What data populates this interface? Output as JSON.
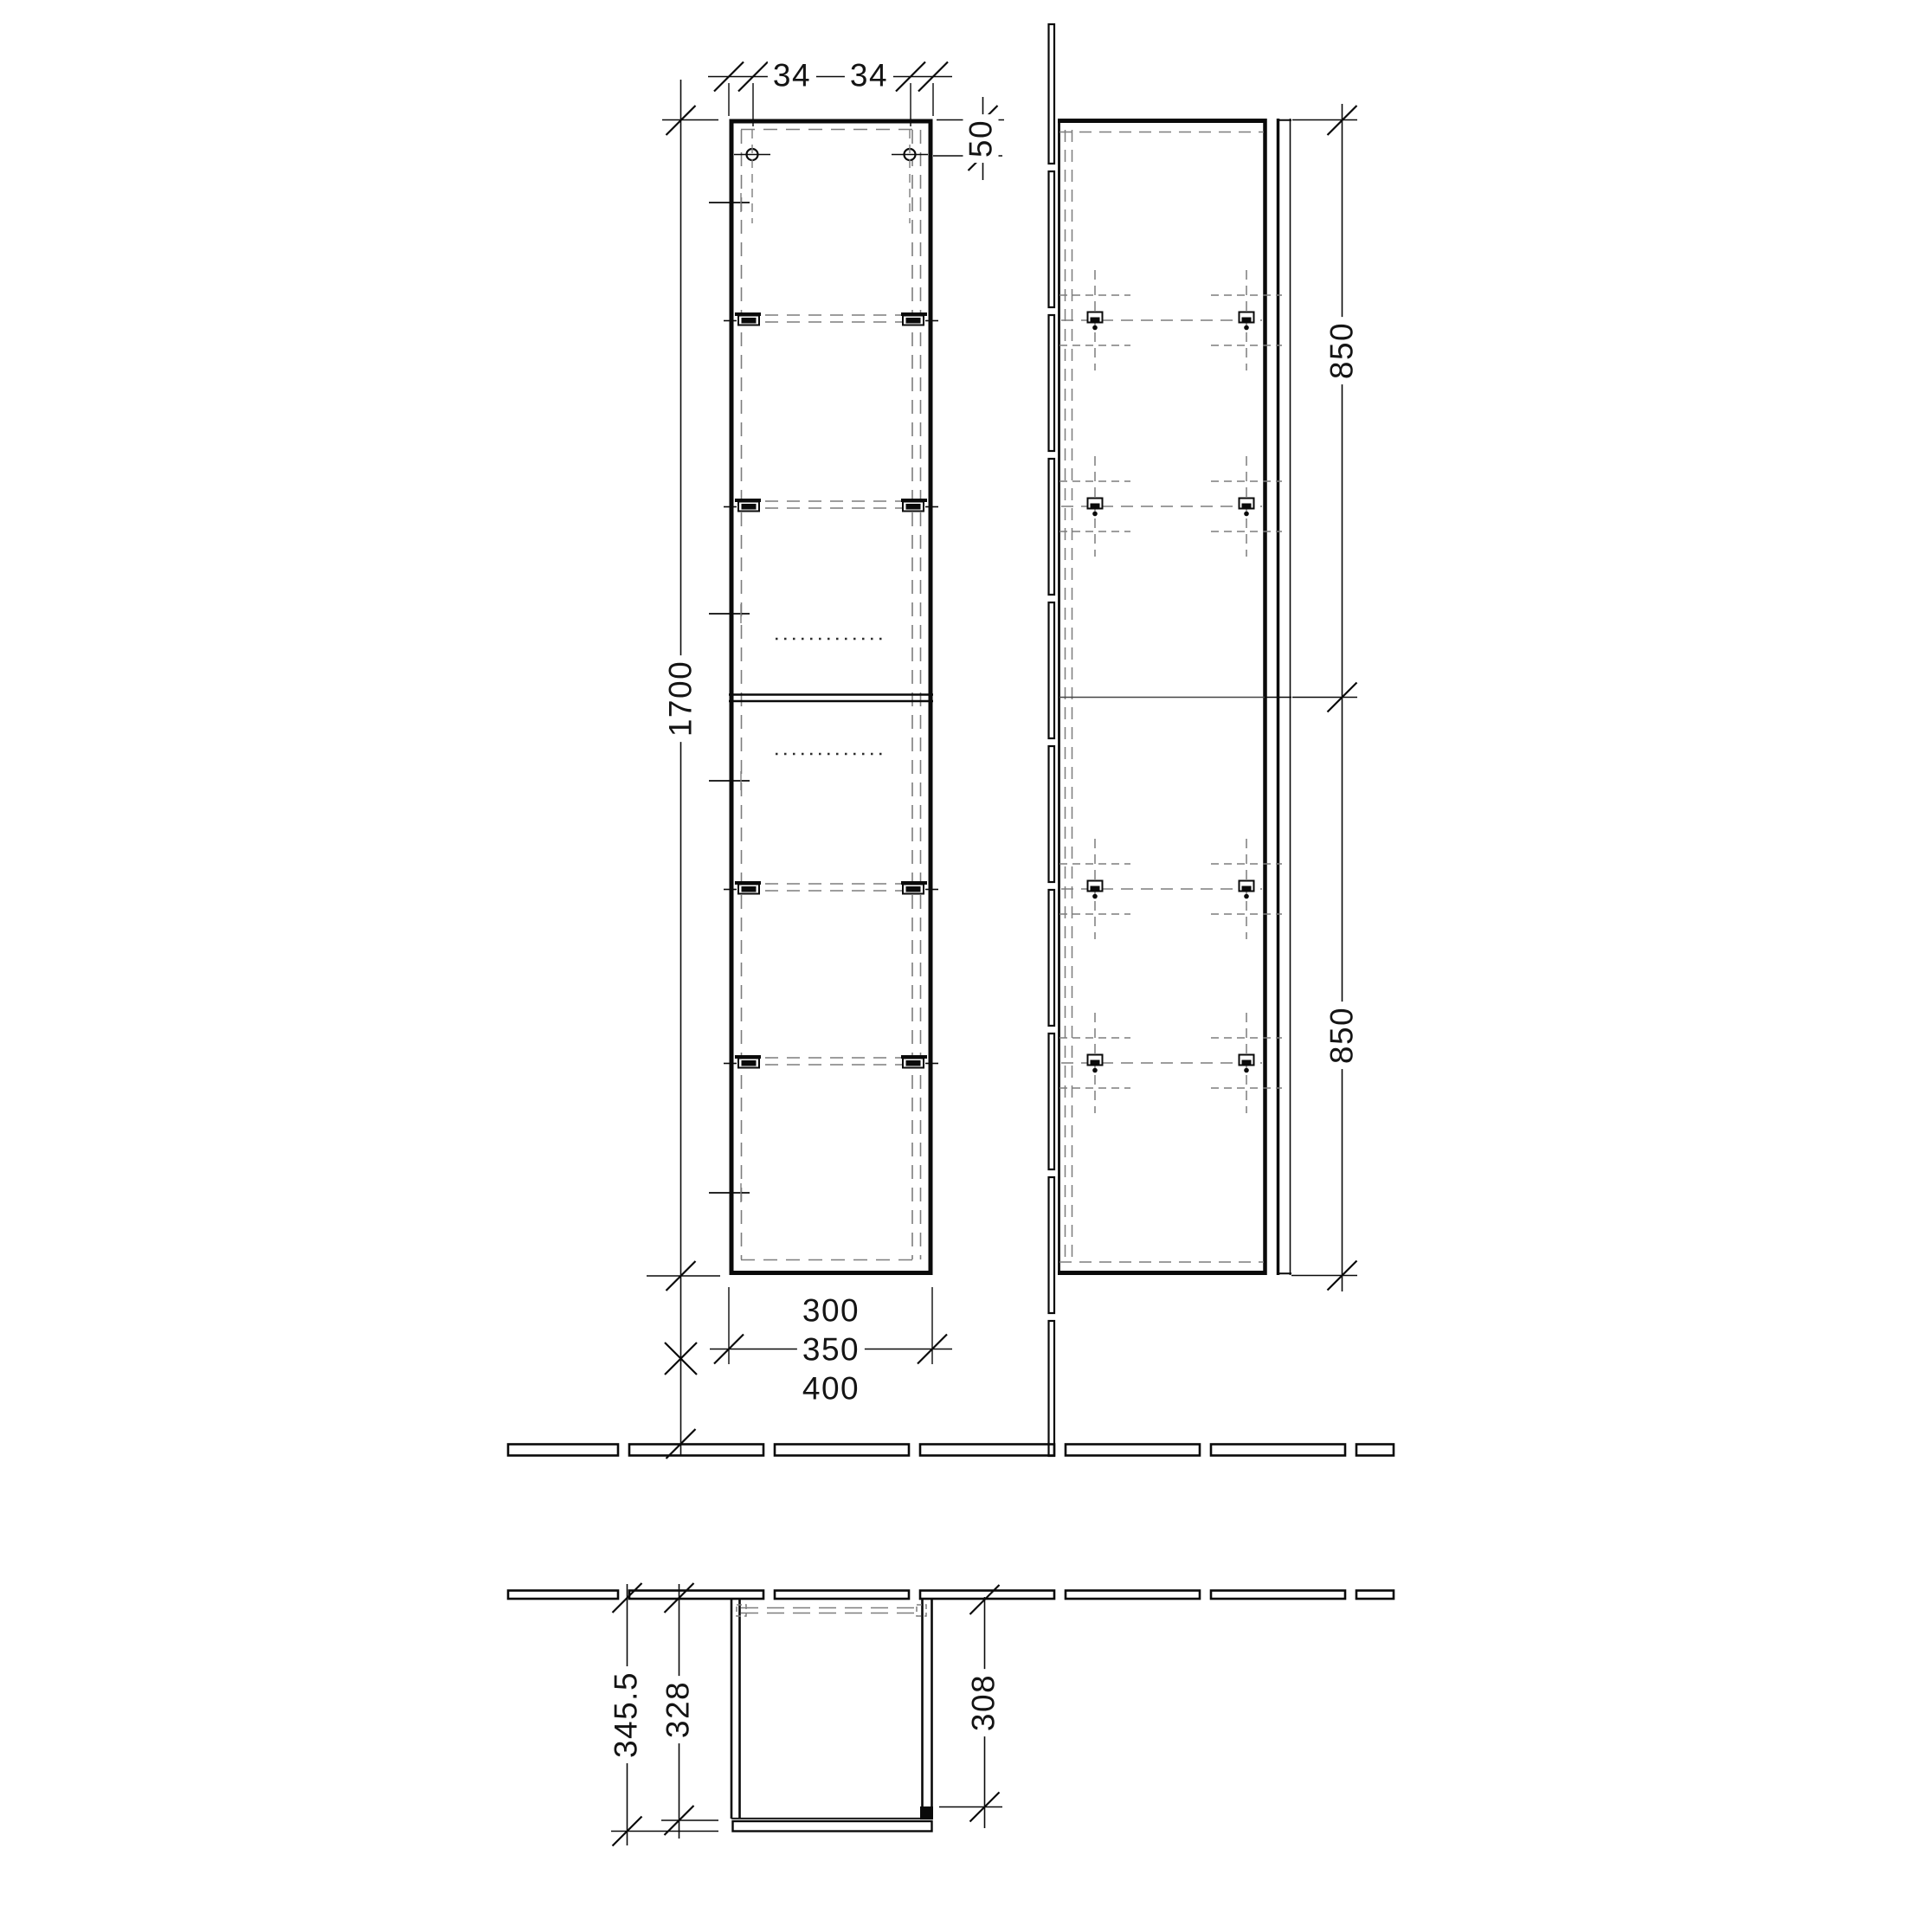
{
  "front_view": {
    "hinge_hole_offset_left": "34",
    "hinge_hole_offset_right": "34",
    "hole_top_offset": "50",
    "cabinet_height": "1700",
    "width_options": [
      "300",
      "350",
      "400"
    ]
  },
  "side_view": {
    "mounting_span_upper": "850",
    "mounting_span_lower": "850"
  },
  "top_view": {
    "depth_overall": "345.5",
    "depth_body": "328",
    "depth_clearance": "308"
  },
  "colors": {
    "line": "#0a0a0a",
    "dashed": "#7d7d7d",
    "background": "#ffffff"
  }
}
